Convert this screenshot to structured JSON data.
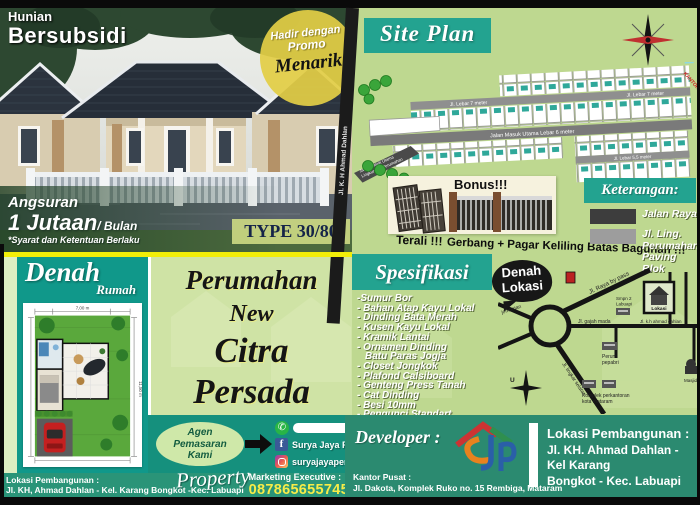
{
  "colors": {
    "teal": "#23a390",
    "teal_dark": "#2b8a70",
    "panel_green": "#bed890",
    "light_green": "#cfe3a5",
    "yellow_divider": "#f2ee08",
    "phone_yellow": "#f7ec48",
    "navy_type": "#152448",
    "promo_yellow": "#e2ce46",
    "road_dark": "#3d3d3d",
    "road_gray": "#9d9d9d"
  },
  "hero": {
    "label_line1": "Hunian",
    "label_line2": "Bersubsidi",
    "promo_line1": "Hadir dengan",
    "promo_line2": "Promo",
    "promo_line3": "Menarik",
    "angsuran_label": "Angsuran",
    "angsuran_amount": "1 Jutaan",
    "angsuran_per": "/ Bulan",
    "angsuran_terms": "*Syarat dan Ketentuan Berlaku",
    "type_label": "TYPE 30/80"
  },
  "site_plan": {
    "title": "Site Plan",
    "road_left": "Jl. K. H Ahmad Dahlan",
    "road_main": "Jalan Masuk Utama Lebar 6 meter",
    "road_7m_a": "Jl. Lebar 7 meter",
    "road_7m_b": "Jl. Lebar 7 meter",
    "road_55m": "Jl. Lebar 5,5 meter",
    "entry_line1": "Jalan Masuk Utama",
    "entry_line2": "Lingkungan Perumahan",
    "corner_note": "KANTOR"
  },
  "bonus": {
    "title": "Bonus!!!",
    "caption_terali": "Terali !!!",
    "caption_rest": "Gerbang + Pagar Keliling Batas Bagunan !!!"
  },
  "keterangan": {
    "title": "Keterangan:",
    "item1": "Jalan Raya",
    "item2_line1": "Jl. Ling. Perumahan",
    "item2_line2": "Paving Blok"
  },
  "denah_rumah": {
    "title": "Denah",
    "subtitle": "Rumah",
    "dim_top": "7,00 m",
    "dim_side": "11,50 m"
  },
  "main_title": {
    "line1": "Perumahan",
    "line2": "New",
    "line3": "Citra",
    "line4": "Persada"
  },
  "agen": {
    "line1": "Agen",
    "line2": "Pemasaran",
    "line3": "Kami",
    "whatsapp_value": "",
    "facebook": "Surya Jaya Persada",
    "instagram": "suryajayapersada_"
  },
  "spesifikasi": {
    "title": "Spesifikasi",
    "items": [
      "-Sumur Bor",
      "- Bahan Atap Kayu Lokal",
      "- Dinding Bata Merah",
      "- Kusen Kayu Lokal",
      "- Kramik Lantai",
      "- Ornamen Dinding",
      "Batu Paras Jogja",
      "- Closet Jongkok",
      "- Plafond Calsiboard",
      "- Genteng Press Tanah",
      "- Cat Dinding",
      "- Besi 10mm",
      "- Pengunci Standart"
    ]
  },
  "lokasi_map": {
    "title_line1": "Denah",
    "title_line2": "Lokasi",
    "jl_raya_bypass": "Jl. Raya by pass",
    "jl_gajah_mada": "Jl. gajah mada",
    "jl_kh_ahmad_dahlan": "Jl. k.h ahmad dahlan",
    "jl_lingkar_selatan": "Jl. lingkar selatan",
    "jembatan": "jembatan",
    "smpn_line1": "Smpn 2",
    "smpn_line2": "Labuapi",
    "lokasi_label": "Lokasi",
    "perum_line1": "Perum",
    "perum_line2": "pepabri",
    "masjid": "Masjid",
    "komplek_line1": "Komplek perkantoran",
    "komplek_line2": "kota mataram",
    "compass": "U"
  },
  "developer": {
    "label": "Developer :",
    "kantor_line1": "Kantor Pusat :",
    "kantor_line2": "Jl. Dakota, Komplek Ruko no. 15 Rembiga, Mataram",
    "lokasi_line1": "Lokasi Pembangunan :",
    "lokasi_line2": "Jl. KH. Ahmad Dahlan - Kel Karang",
    "lokasi_line3": "Bongkot - Kec. Labuapi"
  },
  "bottom": {
    "lokasi_line1": "Lokasi Pembangunan :",
    "lokasi_line2": "Jl. KH, Ahmad Dahlan - Kel. Karang Bongkot -Kec. Labuapi",
    "script": "Property",
    "marketing_label": "Marketing Executive :",
    "phone": "087865655745"
  }
}
